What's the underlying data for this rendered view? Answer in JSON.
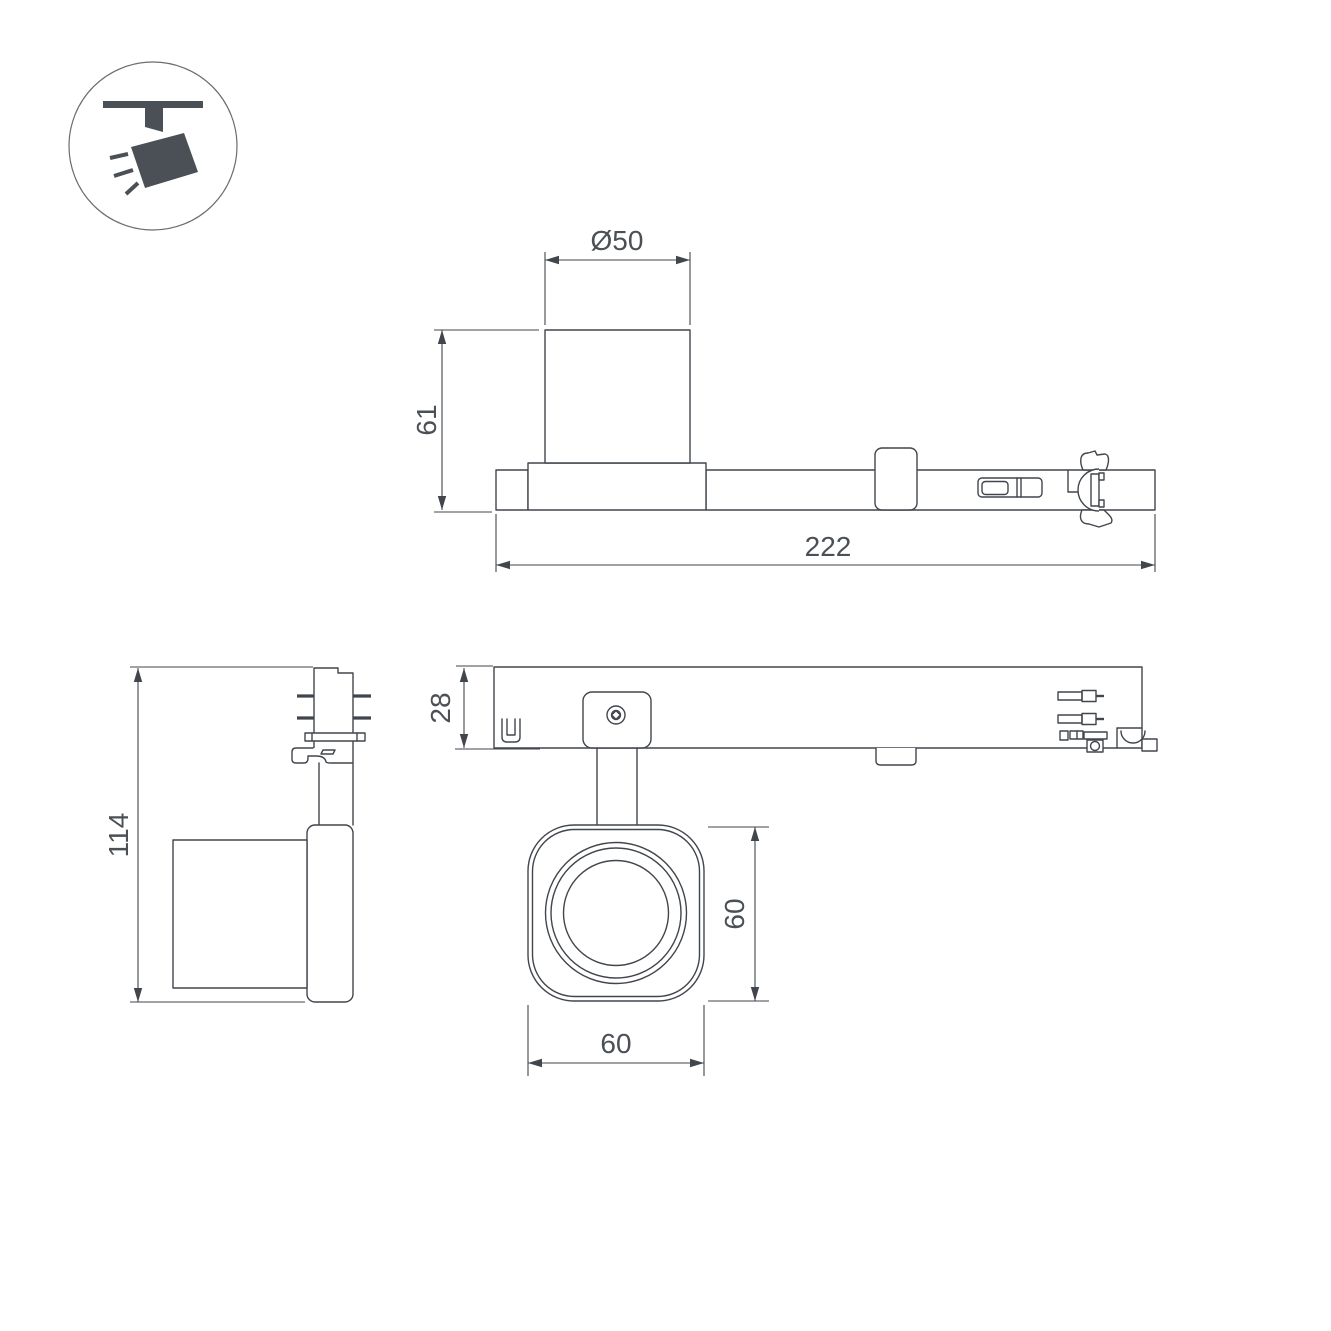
{
  "icon": {
    "name": "ceiling-track-spotlight"
  },
  "colors": {
    "line": "#41464c",
    "icon": "#4b5056",
    "text": "#4b5056",
    "bg": "#ffffff"
  },
  "views": {
    "top": {
      "diameter_label": "Ø50",
      "height_label": "61",
      "length_label": "222"
    },
    "side": {
      "height_label": "114"
    },
    "rail_bottom": {
      "depth_label": "28"
    },
    "head_front": {
      "height_label": "60",
      "width_label": "60"
    }
  }
}
